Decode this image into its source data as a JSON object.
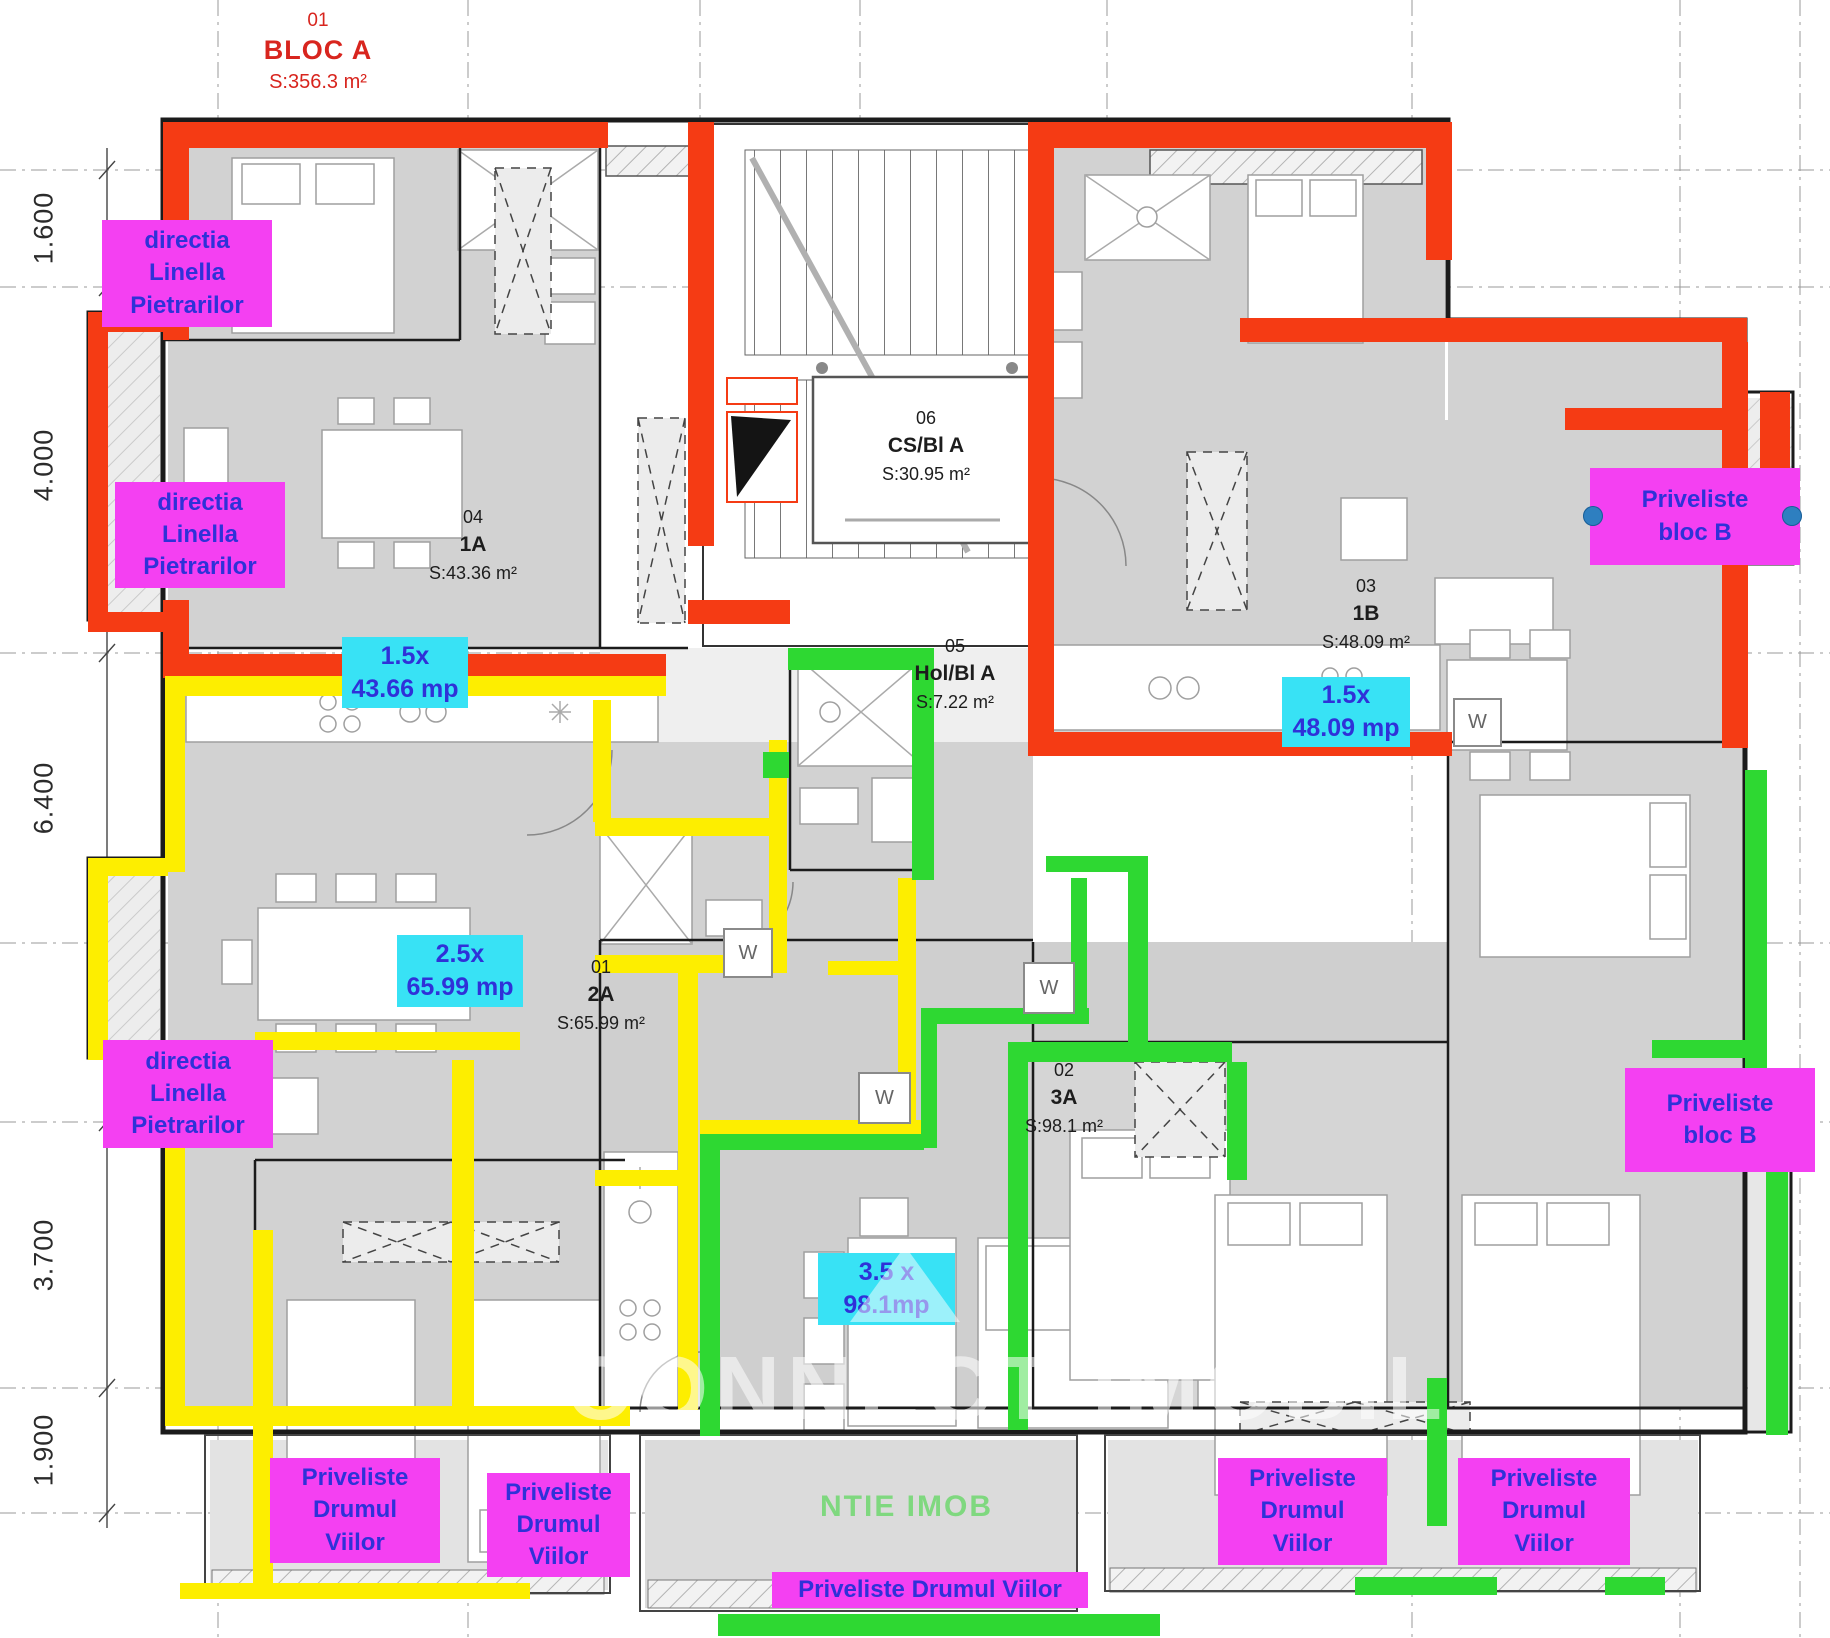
{
  "colors": {
    "red": "#f53b14",
    "yellow": "#fdee00",
    "green": "#2ed832",
    "magenta": "#f440f2",
    "cyan": "#38e2f5",
    "text_blue": "#2f31d8",
    "title_red": "#d8251e",
    "handle_blue": "#2e7fc0"
  },
  "title": {
    "number": "01",
    "name": "BLOC A",
    "area": "S:356.3 m²"
  },
  "dimensions": [
    "1.600",
    "4.000",
    "6.400",
    "3.700",
    "1.900"
  ],
  "rooms": [
    {
      "number": "04",
      "name": "1A",
      "area": "S:43.36 m²"
    },
    {
      "number": "06",
      "name": "CS/Bl A",
      "area": "S:30.95 m²"
    },
    {
      "number": "05",
      "name": "Hol/Bl A",
      "area": "S:7.22 m²"
    },
    {
      "number": "03",
      "name": "1B",
      "area": "S:48.09 m²"
    },
    {
      "number": "01",
      "name": "2A",
      "area": "S:65.99 m²"
    },
    {
      "number": "02",
      "name": "3A",
      "area": "S:98.1 m²"
    }
  ],
  "badges": [
    {
      "factor": "1.5x",
      "area": "43.66 mp"
    },
    {
      "factor": "1.5x",
      "area": "48.09 mp"
    },
    {
      "factor": "2.5x",
      "area": "65.99 mp"
    },
    {
      "factor": "3.5 x",
      "area": "98.1mp"
    }
  ],
  "annotations": {
    "directia": {
      "line1": "directia",
      "line2": "Linella",
      "line3": "Pietrarilor"
    },
    "priveliste_bloc_b": {
      "line1": "Priveliste",
      "line2": "bloc B"
    },
    "priveliste_drumul": {
      "line1": "Priveliste",
      "line2": "Drumul",
      "line3": "Viilor"
    },
    "priveliste_drumul_inline": "Priveliste Drumul Viilor"
  },
  "fixtures": {
    "washer": "W"
  },
  "watermark": {
    "primary": "CONNECT IMOBIL",
    "secondary": "NTIE IMOB"
  }
}
